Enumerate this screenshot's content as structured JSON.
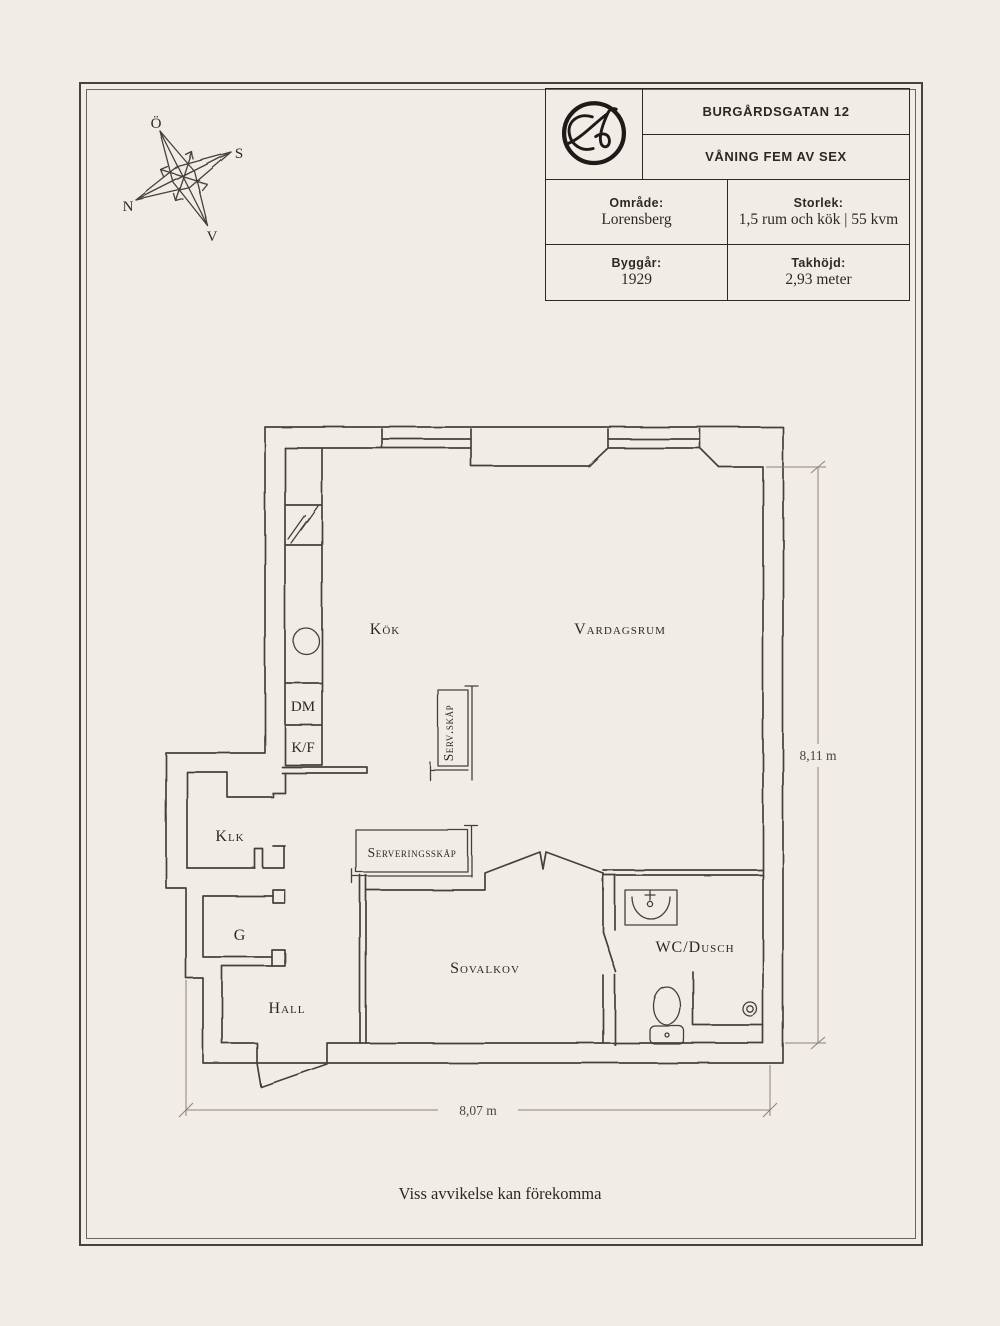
{
  "page": {
    "background": "#f2ece6",
    "line_color": "#45403a",
    "disclaimer": "Viss avvikelse kan förekomma"
  },
  "compass": {
    "labels": {
      "top": "Ö",
      "right": "S",
      "left": "N",
      "bottom": "V"
    }
  },
  "info_table": {
    "logo": "circled-script-A-monogram",
    "address": "BURGÅRDSGATAN 12",
    "floor": "VÅNING FEM AV SEX",
    "cells": [
      {
        "label": "Område:",
        "value": "Lorensberg"
      },
      {
        "label": "Storlek:",
        "value": "1,5 rum och kök | 55 kvm"
      },
      {
        "label": "Byggår:",
        "value": "1929"
      },
      {
        "label": "Takhöjd:",
        "value": "2,93 meter"
      }
    ]
  },
  "floorplan": {
    "labels": {
      "kok": "Kök",
      "vardagsrum": "Vardagsrum",
      "serv_skap": "Serv.skåp",
      "klk": "Klk",
      "serveringsskap": "Serveringsskåp",
      "g": "G",
      "sovalkov": "Sovalkov",
      "wc": "WC/Dusch",
      "hall": "Hall",
      "dm": "DM",
      "kf": "K/F"
    },
    "dimensions": {
      "height": "8,11 m",
      "width": "8,07 m"
    }
  }
}
